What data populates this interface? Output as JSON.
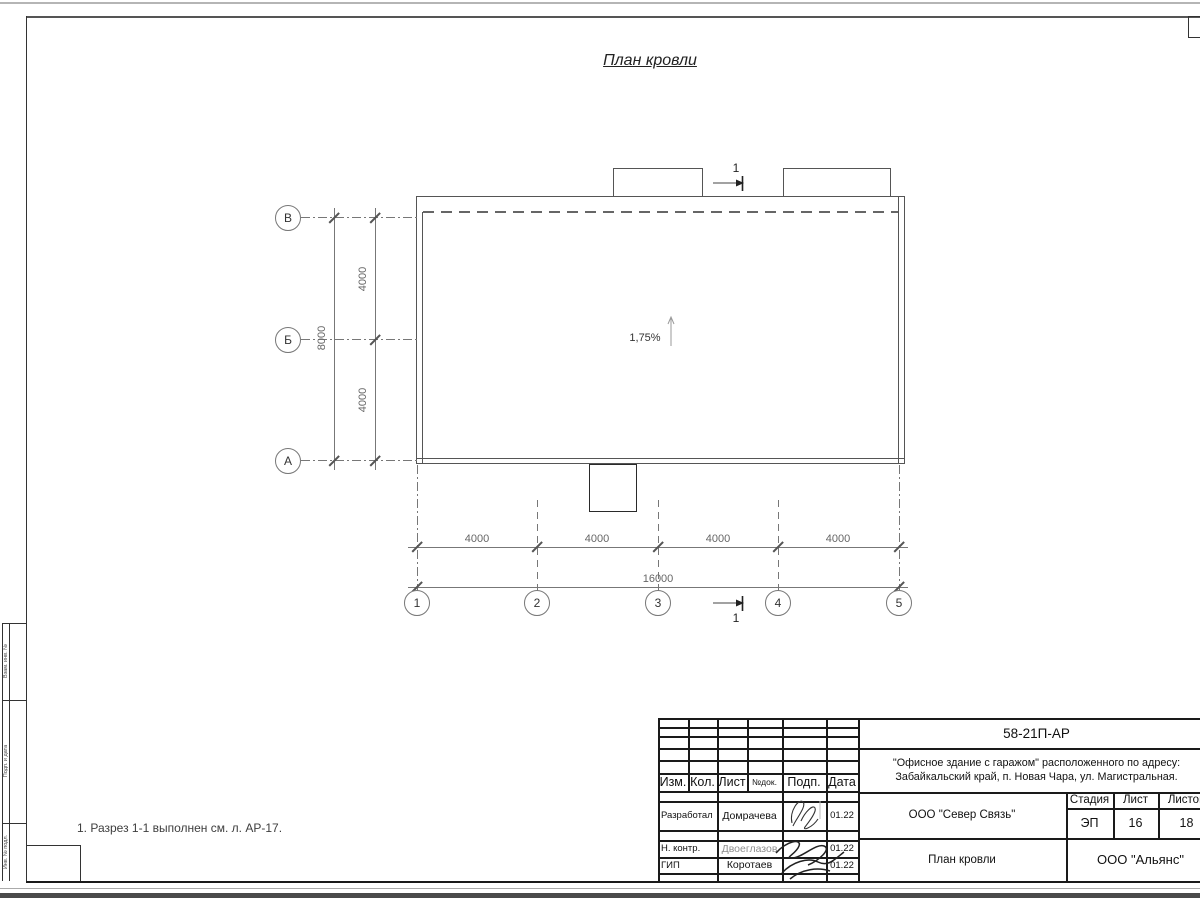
{
  "sheet": {
    "title": "План кровли",
    "note": "1. Разрез 1-1 выполнен см. л. АР-17.",
    "slope": "1,75%",
    "section_mark": "1",
    "row_axes": [
      "В",
      "Б",
      "А"
    ],
    "col_axes": [
      "1",
      "2",
      "3",
      "4",
      "5"
    ],
    "dims": {
      "v_seg": [
        "4000",
        "4000"
      ],
      "v_total": "8000",
      "h_seg": [
        "4000",
        "4000",
        "4000",
        "4000"
      ],
      "h_total": "16000"
    }
  },
  "titleblock": {
    "doc_number": "58-21П-АР",
    "project_line1": "\"Офисное здание с гаражом\" расположенного по адресу:",
    "project_line2": "Забайкальский край, п. Новая Чара, ул. Магистральная.",
    "contractor": "ООО \"Север Связь\"",
    "sheet_name": "План кровли",
    "company": "ООО \"Альянс\"",
    "cols": {
      "izm": "Изм.",
      "kol": "Кол.",
      "list": "Лист",
      "ndok": "№док.",
      "podp": "Подп.",
      "data": "Дата"
    },
    "stage_label": "Стадия",
    "sheet_label": "Лист",
    "sheets_label": "Листов",
    "stage": "ЭП",
    "sheet_no": "16",
    "sheets_total": "18",
    "roles": [
      {
        "role": "Разработал",
        "name": "Домрачева",
        "date": "01.22"
      },
      {
        "role": "Н. контр.",
        "name": "Двоеглазов",
        "date": "01.22"
      },
      {
        "role": "ГИП",
        "name": "Коротаев",
        "date": "01.22"
      }
    ]
  },
  "side_stamps": [
    "Взам. инв. №",
    "Подп. и дата",
    "Инв. № подл."
  ]
}
